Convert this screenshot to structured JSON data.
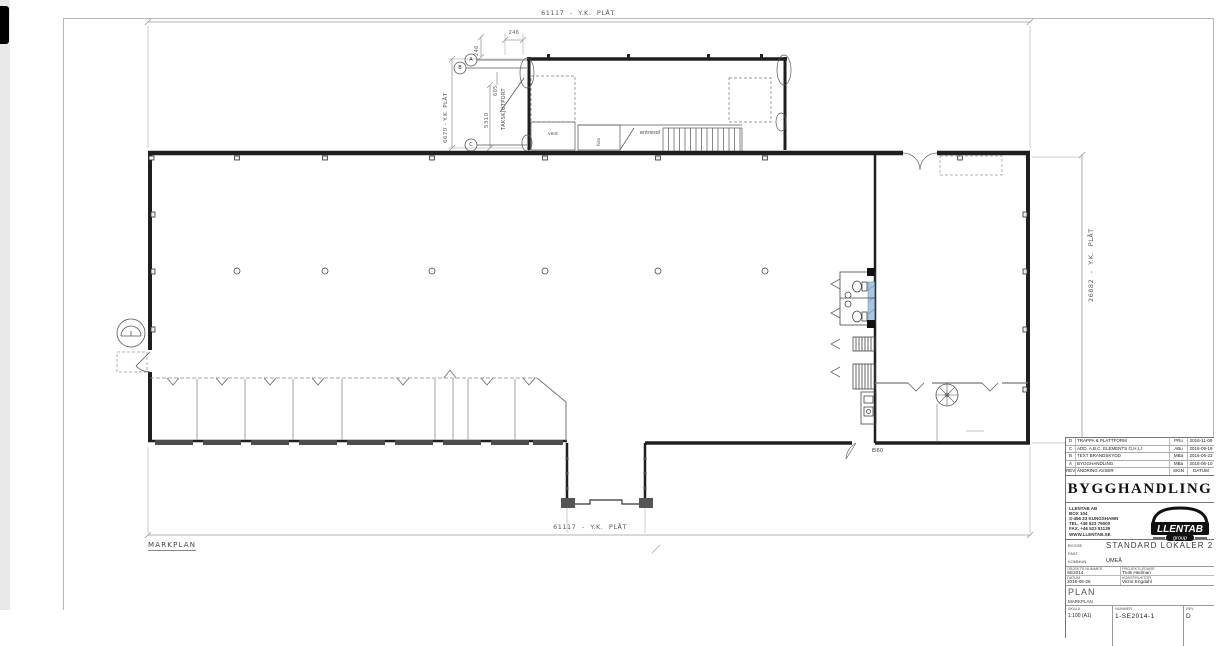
{
  "plan": {
    "dim_top": "61117 - Y.K. PLÅT",
    "dim_bottom": "61117 - Y.K. PLÅT",
    "dim_right": "26882 - Y.K. PLÅT",
    "dim_annex_height": "6670 - Y.K. PLÅT",
    "dim_5310": "5310",
    "dim_605": "605",
    "dim_246_vertical": "246",
    "dim_246_horizontal": "246",
    "label_takskjutport": "TAKSKJUTPORT",
    "detail_a": "A",
    "detail_b": "B",
    "detail_c": "C",
    "room_vent": "vent",
    "room_hiss": "hiss",
    "room_entresol": "entresol",
    "label_ei60": "EI60",
    "label_markplan": "MARKPLAN"
  },
  "titleblock": {
    "revisions": [
      {
        "rev": "D",
        "desc": "TRAPPA & PLATTFORM",
        "sign": "PRu",
        "date": "2016-11-09"
      },
      {
        "rev": "C",
        "desc": "ADD. A,B,C, ELEMENTS G,H,I,J",
        "sign": "ABu",
        "date": "2016-09-19"
      },
      {
        "rev": "B",
        "desc": "TEXT BRANDSKYDD",
        "sign": "MBa",
        "date": "2016-06-23"
      },
      {
        "rev": "A",
        "desc": "BYGGHANDLING",
        "sign": "MBa",
        "date": "2016-06-10"
      }
    ],
    "rev_header": {
      "rev": "REV",
      "desc": "ÄNDRING AVSER",
      "sign": "SIGN",
      "date": "DATUM"
    },
    "doc_type": "BYGGHANDLING",
    "company": {
      "line1": "LLENTAB AB",
      "line2": "BOX 104",
      "line3": "S-456 23 KUNGSHAMN",
      "line4": "TEL. +46 523 79000",
      "line5": "FAX. +46 523 51139",
      "line6": "WWW.LLENTAB.SE",
      "logo_text": "LLENTAB",
      "logo_sub": "group"
    },
    "fields": {
      "bygge_label": "BYGGE",
      "bygge": "STANDARD LOKALER 2",
      "fast_label": "FAST.",
      "kommun_label": "KOMMUN",
      "kommun": "UMEÅ",
      "objekt_label": "OBJEKTS NUMMER",
      "objekt": "SE2014",
      "projektledare_label": "PROJEKTLEDARE",
      "projektledare": "Truls Hedman",
      "datum_label": "DATUM",
      "datum": "2016-05-26",
      "konstruktor_label": "KONSTRUKTÖR",
      "konstruktor": "Victor Engdahl"
    },
    "plan_label": "PLAN",
    "plan_sub": "MARKPLAN",
    "skala_label": "SKALA",
    "skala": "1:100 (A1)",
    "nummer_label": "NUMMER",
    "nummer": "1-SE2014-1",
    "rev_label": "REV",
    "rev": "D"
  }
}
